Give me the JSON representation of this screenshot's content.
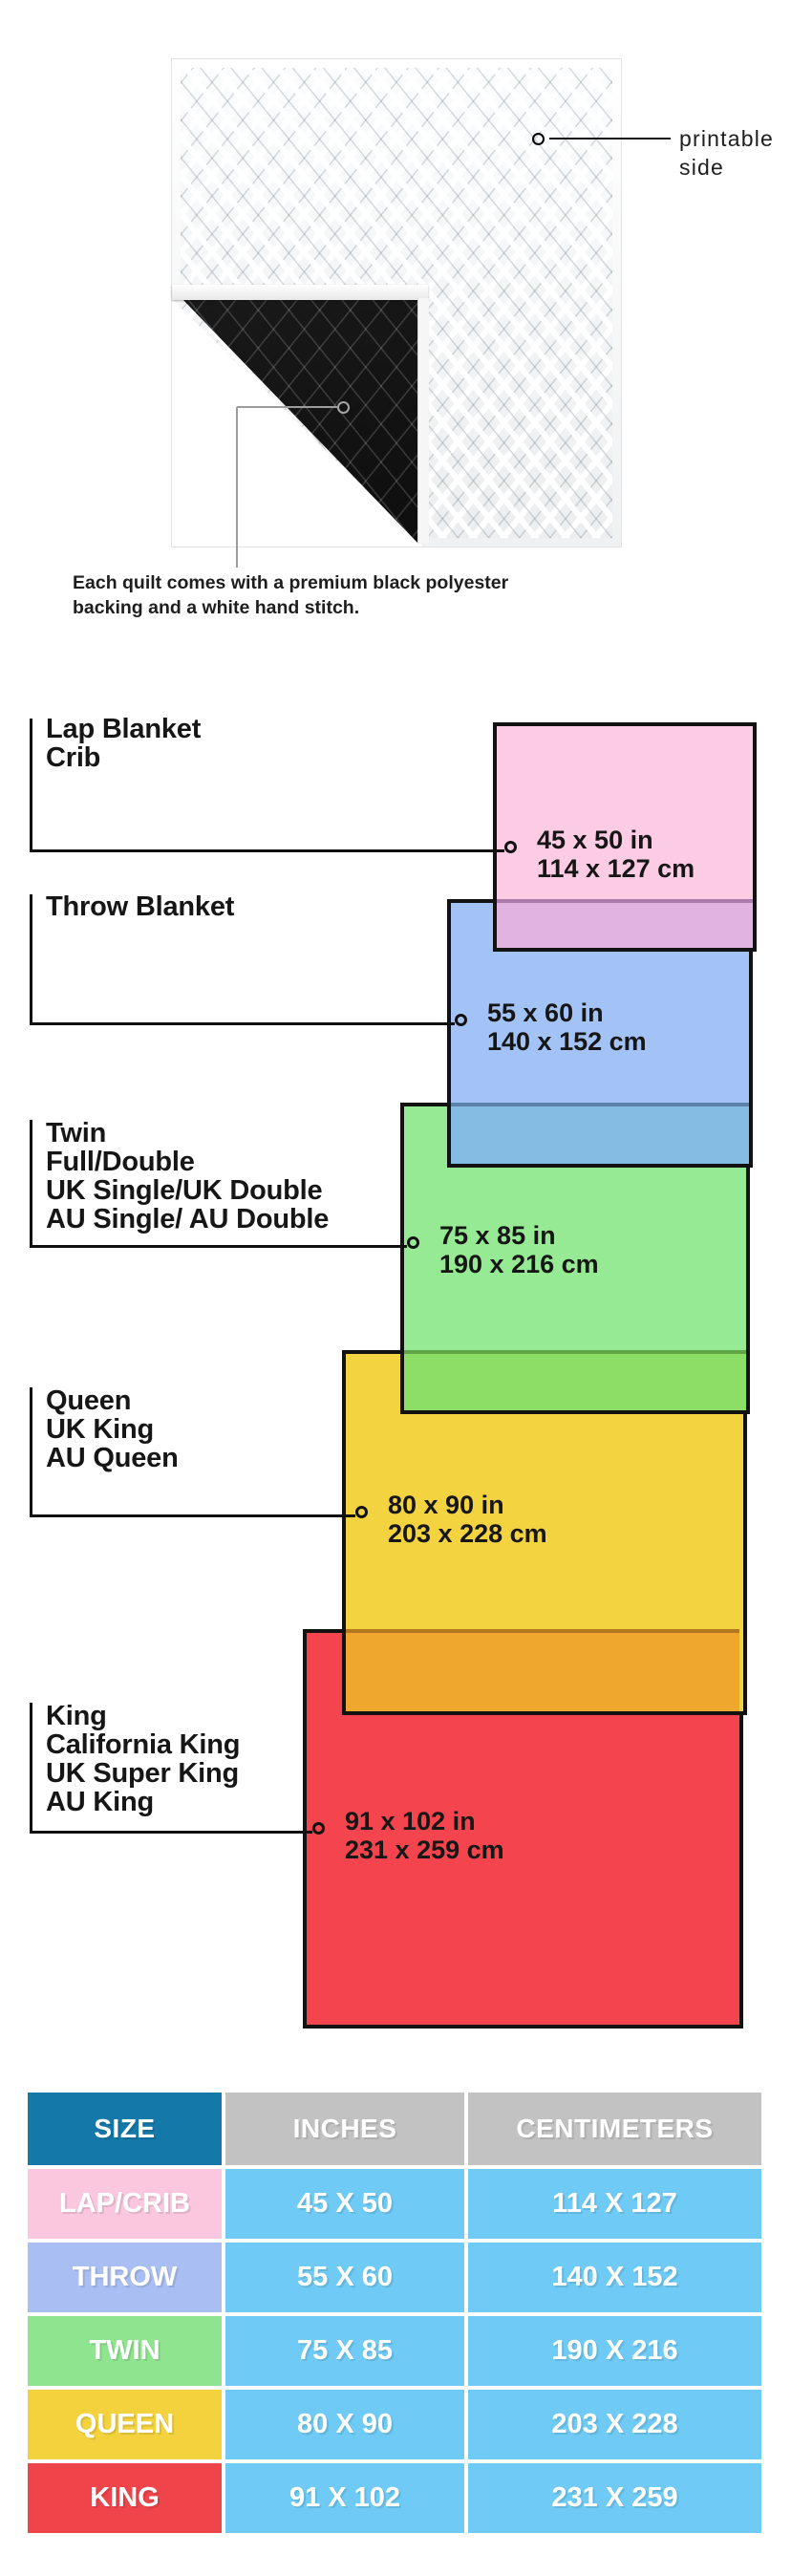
{
  "hero": {
    "printable_annotation": "printable\nside",
    "caption": "Each quilt comes with a premium black polyester\nbacking and a white hand stitch.",
    "quilt_front_color": "#ffffff",
    "quilt_backing_color": "#141414"
  },
  "diagram": {
    "border_color": "#121212",
    "items": [
      {
        "id": "lap",
        "label": "Lap Blanket\nCrib",
        "size": "45 x 50 in\n114 x 127 cm",
        "color": "#FCCBE4"
      },
      {
        "id": "throw",
        "label": "Throw Blanket",
        "size": "55 x 60 in\n140 x 152 cm",
        "color": "#A3C2F5"
      },
      {
        "id": "twin",
        "label": "Twin\nFull/Double\nUK Single/UK Double\nAU Single/ AU Double",
        "size": "75 x 85 in\n190 x 216 cm",
        "color": "#96EA93"
      },
      {
        "id": "queen",
        "label": "Queen\nUK King\nAU Queen",
        "size": "80 x 90 in\n203 x 228 cm",
        "color": "#F3D33F"
      },
      {
        "id": "king",
        "label": "King\nCalifornia King\nUK Super King\nAU King",
        "size": "91 x 102 in\n231 x 259 cm",
        "color": "#F4454E"
      }
    ],
    "overlap_colors": {
      "pink_over_blue": "#E0B3E0",
      "blue_over_green": "#84BCE4",
      "green_over_yellow": "#8CDE66",
      "yellow_over_red": "#F0A72E"
    }
  },
  "table": {
    "headers": {
      "size": "SIZE",
      "inches": "INCHES",
      "centimeters": "CENTIMETERS"
    },
    "header_colors": {
      "size": "#1478A8",
      "units": "#C2C2C2"
    },
    "value_cell_color": "#6FCBF5",
    "rows": [
      {
        "size": "LAP/CRIB",
        "inches": "45 X 50",
        "centimeters": "114 X 127",
        "color": "#FAC7DE"
      },
      {
        "size": "THROW",
        "inches": "55 X 60",
        "centimeters": "140 X 152",
        "color": "#A9BEF2"
      },
      {
        "size": "TWIN",
        "inches": "75 X 85",
        "centimeters": "190 X 216",
        "color": "#8FE58F"
      },
      {
        "size": "QUEEN",
        "inches": "80 X 90",
        "centimeters": "203 X 228",
        "color": "#F3D23D"
      },
      {
        "size": "KING",
        "inches": "91 X 102",
        "centimeters": "231 X 259",
        "color": "#F0444B"
      }
    ]
  }
}
